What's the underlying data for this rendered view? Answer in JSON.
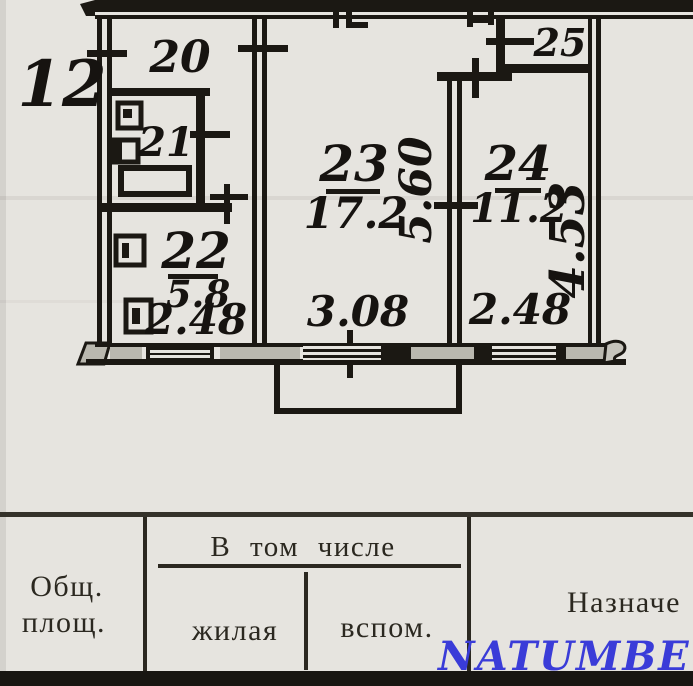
{
  "plan": {
    "building_label": "12",
    "rooms": {
      "r20": {
        "number": "20"
      },
      "r21": {
        "number": "21"
      },
      "r22": {
        "number": "22",
        "area": "5.8"
      },
      "r23": {
        "number": "23",
        "area": "17.2"
      },
      "r24": {
        "number": "24",
        "area": "11.2"
      },
      "r25": {
        "number": "25"
      }
    },
    "dimensions": {
      "bottom_left": "2.48",
      "bottom_middle": "3.08",
      "bottom_right": "2.48",
      "side_middle": "5.60",
      "side_right": "4.53"
    }
  },
  "table": {
    "col_total_line1": "Общ.",
    "col_total_line2": "площ.",
    "header_including": "В том числе",
    "col_living": "жилая",
    "col_auxiliary": "вспом.",
    "col_purpose": "Назначе"
  },
  "watermark": {
    "text": "NATUMBE. KZ",
    "color": "#3a3cd8"
  },
  "colors": {
    "paper": "#e6e4df",
    "ink": "#1b1813",
    "window_sill": "#bab8af",
    "watermark_blue": "#3a3cd8"
  }
}
